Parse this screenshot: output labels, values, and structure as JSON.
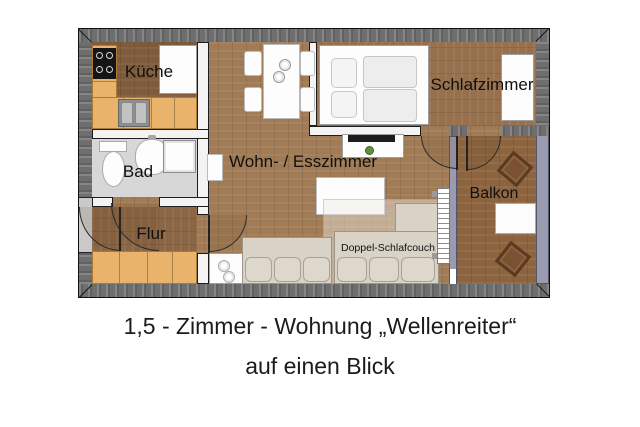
{
  "caption": {
    "line1": "1,5 - Zimmer - Wohnung „Wellenreiter“",
    "line2": "auf einen Blick"
  },
  "rooms": {
    "kueche": "Küche",
    "bad": "Bad",
    "flur": "Flur",
    "wohnzimmer": "Wohn- / Esszimmer",
    "schlafzimmer": "Schlafzimmer",
    "balkon": "Balkon"
  },
  "furniture": {
    "sleep_couch": "Doppel-Schlafcouch"
  },
  "colors": {
    "wall": "#6e6e6e",
    "glass_wall": "#9b9bb0",
    "wood_living": "#a17b55",
    "wood_kitchen": "#7e5b3b",
    "wood_flur": "#8a6644",
    "wood_bedroom": "#97714d",
    "wood_balcony": "#8d6440",
    "counter": "#eab36c",
    "bath_floor": "#d7d7d7",
    "couch": "#d9d2c6"
  }
}
